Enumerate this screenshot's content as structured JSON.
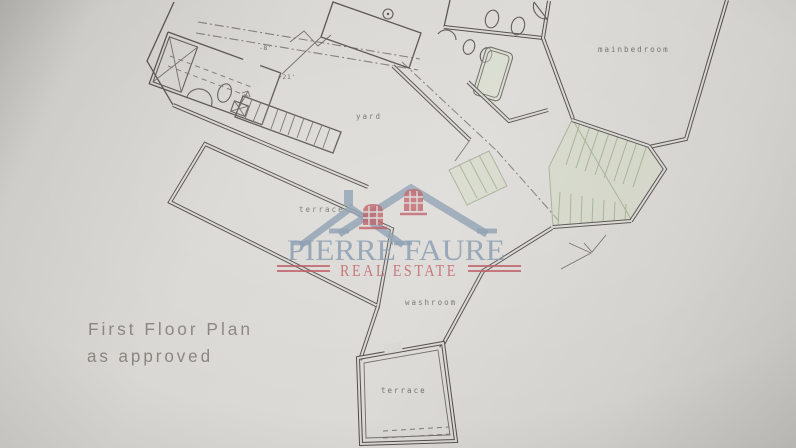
{
  "plan": {
    "title_line1": "First Floor Plan",
    "title_line2": "as approved",
    "rooms": {
      "mainbedroom": "mainbedroom",
      "yard": "yard",
      "terrace_upper": "terrace",
      "washroom": "washroom",
      "terrace_lower": "terrace"
    },
    "annotations": {
      "level_a": "-8'",
      "level_b": "+21'"
    }
  },
  "watermark": {
    "name": "PIERRE FAURE",
    "tagline": "REAL ESTATE",
    "logo": "double-house-roof-logo",
    "name_color": "#8095ab",
    "tagline_color": "#bf5c65"
  },
  "colors": {
    "paper": "#d8d6d2",
    "ink": "#55524d",
    "stair_green": "#a2ac91",
    "title_gray": "#84817b"
  }
}
